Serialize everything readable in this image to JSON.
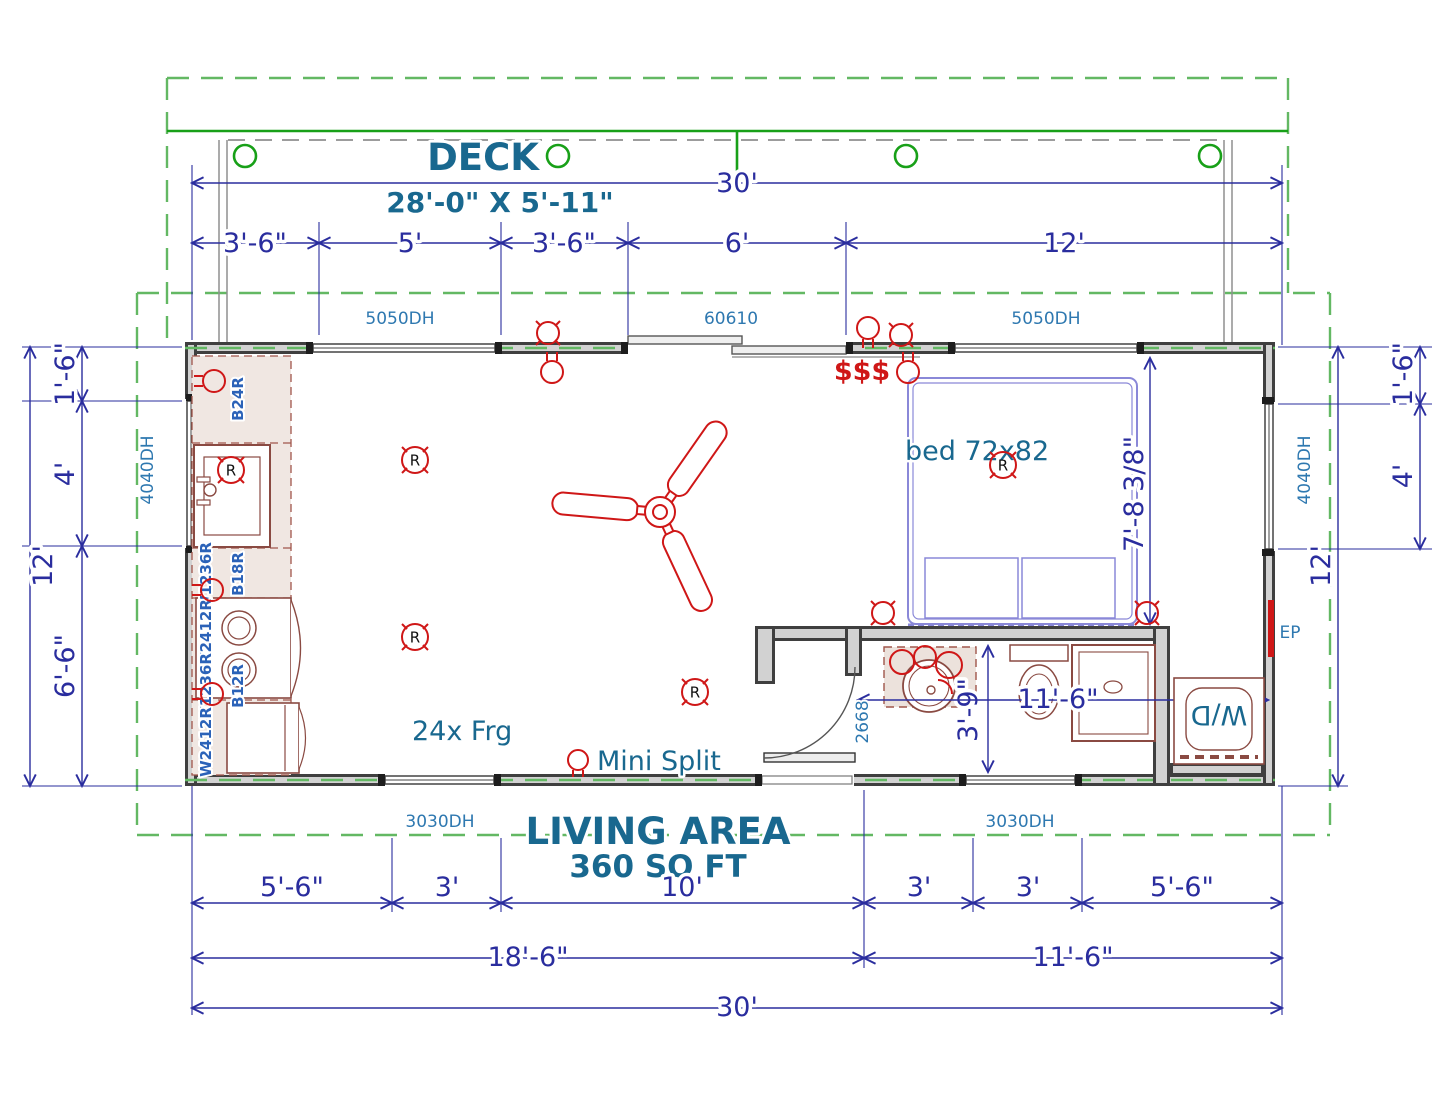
{
  "title": {
    "deck": "DECK",
    "deck_size": "28'-0\" X 5'-11\"",
    "living_area": "LIVING AREA",
    "living_sqft": "360 SQ FT"
  },
  "labels": {
    "bed": "bed 72x82",
    "mini_split": "Mini Split",
    "fridge": "24x Frg",
    "washer_dryer": "W/D",
    "electrical_panel": "EP",
    "switches": "$$$",
    "receptacle": "R"
  },
  "openings": {
    "window_5050": "5050DH",
    "slider_60610": "60610",
    "window_4040": "4040DH",
    "window_3030": "3030DH",
    "door_2668": "2668"
  },
  "cabinets": {
    "b24r": "B24R",
    "b18r": "B18R",
    "b12r": "B12R",
    "w1236r": "W1236R",
    "w2412r": "W2412R"
  },
  "dims": {
    "top": {
      "overall": "30'",
      "segs": [
        "3'-6\"",
        "5'",
        "3'-6\"",
        "6'",
        "12'"
      ]
    },
    "left": {
      "overall": "12'",
      "segs": [
        "1'-6\"",
        "4'",
        "6'-6\""
      ]
    },
    "right": {
      "overall": "12'",
      "segs": [
        "1'-6\"",
        "4'"
      ]
    },
    "bottom": {
      "segs": [
        "5'-6\"",
        "3'",
        "10'",
        "3'",
        "3'",
        "5'-6\""
      ],
      "groups": [
        "18'-6\"",
        "11'-6\""
      ],
      "overall": "30'"
    },
    "interior": {
      "bed_wall": "7'-8 3/8\"",
      "bath_depth": "3'-9\"",
      "bath_width": "11'-6\""
    }
  },
  "colors": {
    "dimension_blue": "#2a2d9e",
    "label_blue": "#2e78b0",
    "title_blue": "#19688f",
    "electrical_red": "#cf1717",
    "deck_green": "#18a018",
    "roof_green": "#63b863",
    "wall_gray": "#3f3f3f",
    "cabinet_brown": "#8a4a42",
    "bed_purple": "#8a88d8"
  }
}
